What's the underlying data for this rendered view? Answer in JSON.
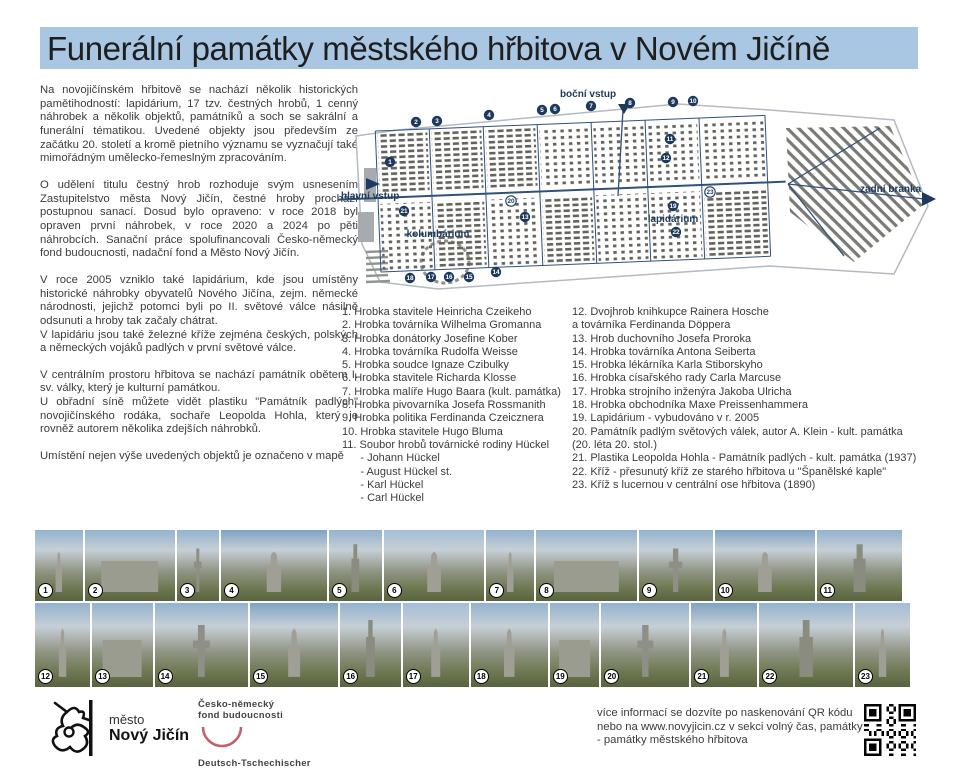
{
  "title": "Funerální památky městského hřbitova v Novém Jičíně",
  "intro_paragraphs": [
    "Na novojičínském hřbitově se nachází několik historických pamětihodností: lapidárium, 17 tzv. čestných hrobů, 1 cenný náhrobek a několik objektů, památníků a soch se sakrální a funerální tématikou. Uvedené objekty jsou především ze začátku 20. století a kromě pietního významu se vyznačují také mimořádným umělecko-řemeslným zpracováním.",
    "O udělení titulu čestný hrob rozhoduje svým usnesením Zastupitelstvo města Nový Jičín, čestné hroby prochází postupnou sanací. Dosud bylo opraveno: v roce 2018 byl opraven první náhrobek, v roce 2020 a 2024 po pěti náhrobcích. Sanační práce spolufinancovali Česko-německý fond budoucnosti, nadační fond a Město Nový Jičín.",
    "V roce 2005 vzniklo také lapidárium, kde jsou umístěny historické náhrobky obyvatelů Nového Jičína, zejm. německé národnosti, jejichž potomci byli po II. světové válce násilně odsunuti a hroby tak začaly chátrat.\nV lapidáriu jsou také železné kříže zejména českých, polských a německých vojáků padlých v první světové válce.",
    "V centrálním prostoru hřbitova se nachází památník obětem I. sv. války, který je kulturní památkou.\nU obřadní síně můžete vidět plastiku \"Památník padlých\" novojičínského rodáka, sochaře Leopolda Hohla, který je rovněž autorem několika zdejších náhrobků.",
    "Umístění nejen výše uvedených objektů je označeno v mapě"
  ],
  "map": {
    "labels": {
      "main_entrance": "hlavní vstup",
      "side_entrance": "boční vstup",
      "rear_gate": "zadní branka",
      "columbarium": "kolumbárium",
      "lapidarium": "lapidárium"
    },
    "markers": [
      {
        "n": 1,
        "x": 52,
        "y": 78
      },
      {
        "n": 2,
        "x": 78,
        "y": 38
      },
      {
        "n": 3,
        "x": 99,
        "y": 37
      },
      {
        "n": 4,
        "x": 151,
        "y": 31
      },
      {
        "n": 5,
        "x": 204,
        "y": 26
      },
      {
        "n": 6,
        "x": 217,
        "y": 25
      },
      {
        "n": 7,
        "x": 253,
        "y": 22
      },
      {
        "n": 8,
        "x": 292,
        "y": 19
      },
      {
        "n": 9,
        "x": 335,
        "y": 18
      },
      {
        "n": 10,
        "x": 355,
        "y": 17
      },
      {
        "n": 11,
        "x": 332,
        "y": 55
      },
      {
        "n": 12,
        "x": 328,
        "y": 74
      },
      {
        "n": 13,
        "x": 187,
        "y": 133
      },
      {
        "n": 14,
        "x": 158,
        "y": 188
      },
      {
        "n": 15,
        "x": 131,
        "y": 193
      },
      {
        "n": 16,
        "x": 111,
        "y": 193
      },
      {
        "n": 17,
        "x": 93,
        "y": 193
      },
      {
        "n": 18,
        "x": 72,
        "y": 194
      },
      {
        "n": 19,
        "x": 335,
        "y": 122
      },
      {
        "n": 20,
        "x": 173,
        "y": 117,
        "w": 1
      },
      {
        "n": 21,
        "x": 66,
        "y": 127
      },
      {
        "n": 22,
        "x": 338,
        "y": 148
      },
      {
        "n": 23,
        "x": 372,
        "y": 108,
        "w": 1
      }
    ]
  },
  "list_left": [
    "1. Hrobka stavitele Heinricha Czeikeho",
    "2. Hrobka továrníka Wilhelma Gromanna",
    "3. Hrobka donátorky Josefine Kober",
    "4. Hrobka továrníka Rudolfa Weisse",
    "5. Hrobka soudce Ignaze Czibulky",
    "6. Hrobka stavitele Richarda Klosse",
    "7. Hrobka malíře Hugo Baara (kult. památka)",
    "8. Hrobka pivovarníka Josefa Rossmanith",
    "9. Hrobka politika Ferdinanda Czeicznera",
    "10. Hrobka stavitele Hugo Bluma",
    "11. Soubor hrobů továrnické rodiny Hückel",
    "      - Johann Hückel",
    "      - August Hückel st.",
    "      - Karl Hückel",
    "      - Carl Hückel"
  ],
  "list_right": [
    "12. Dvojhrob knihkupce Rainera Hosche",
    "a továrníka Ferdinanda Döppera",
    "13. Hrob duchovního Josefa Proroka",
    "14. Hrobka továrníka Antona Seiberta",
    "15. Hrobka lékárníka Karla Stiborskyho",
    "16. Hrobka císařského rady Carla Marcuse",
    "17. Hrobka strojního inženýra Jakoba Ulricha",
    "18. Hrobka obchodníka Maxe Preissenhammera",
    "19. Lapidárium - vybudováno v r. 2005",
    "20. Památník padlým světových válek, autor A. Klein - kult. památka",
    "(20. léta 20. stol.)",
    "21. Plastika Leopolda Hohla - Památník padlých - kult. památka (1937)",
    "22. Kříž - přesunutý kříž ze starého hřbitova u \"Španělské kaple\"",
    "23. Kříž s lucernou v centrální ose hřbitova (1890)"
  ],
  "photos": {
    "row1": [
      "1",
      "2",
      "3",
      "4",
      "5",
      "6",
      "7",
      "8",
      "9",
      "10",
      "11"
    ],
    "row2": [
      "12",
      "13",
      "14",
      "15",
      "16",
      "17",
      "18",
      "19",
      "20",
      "21",
      "22",
      "23"
    ]
  },
  "footer": {
    "city_logo": {
      "line1": "město",
      "line2": "Nový Jičín"
    },
    "fund_logo": {
      "top1": "Česko-německý",
      "top2": "fond budoucnosti",
      "bottom1": "Deutsch-Tschechischer",
      "bottom2": "Zukunftsfonds"
    },
    "info_text": "více informací se dozvíte po naskenování QR kódu\nnebo na www.novyjicin.cz v sekci volný čas, památky\n- památky městského hřbitova"
  },
  "colors": {
    "title_bg": "#a9c6e3",
    "map_navy": "#1d3a5e",
    "map_grave_gray": "#63635b",
    "fund_logo_red": "#c4606b"
  }
}
